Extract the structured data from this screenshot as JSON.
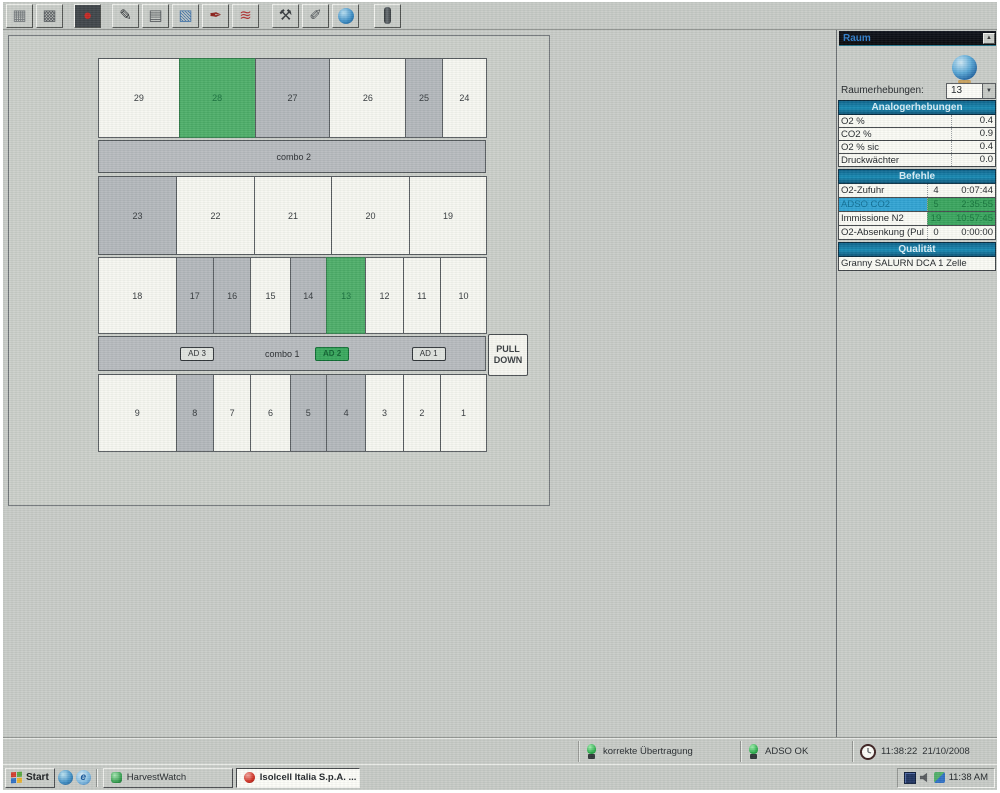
{
  "toolbar": {
    "icons": [
      {
        "name": "grid-icon",
        "glyph": "▦",
        "fg": "#6d7276",
        "ml": 0
      },
      {
        "name": "calendar-table-icon",
        "glyph": "▩",
        "fg": "#54585c",
        "ml": 0
      },
      {
        "name": "record-icon",
        "glyph": "●",
        "fg": "#c42420",
        "ml": 8,
        "cls": "dark"
      },
      {
        "name": "report-edit-icon",
        "glyph": "✎",
        "fg": "#26292c",
        "ml": 8
      },
      {
        "name": "table-icon",
        "glyph": "▤",
        "fg": "#4e5256",
        "ml": 0
      },
      {
        "name": "table-chart-icon",
        "glyph": "▧",
        "fg": "#3a6ea5",
        "ml": 0
      },
      {
        "name": "signature-icon",
        "glyph": "✒",
        "fg": "#8a1c16",
        "ml": 0
      },
      {
        "name": "line-chart-icon",
        "glyph": "≋",
        "fg": "#b03030",
        "ml": 0
      },
      {
        "name": "tools-icon",
        "glyph": "⚒",
        "fg": "#34383c",
        "ml": 10
      },
      {
        "name": "ink-pen-icon",
        "glyph": "✐",
        "fg": "#4a4e52",
        "ml": 0
      },
      {
        "name": "globe-toolbar-icon",
        "cls": "globe",
        "ml": 0
      },
      {
        "name": "thermometer-icon",
        "cls": "thermo",
        "ml": 12
      }
    ]
  },
  "room_map": {
    "pull_down_label": "PULL DOWN",
    "rows": [
      {
        "h": 80,
        "cells": [
          {
            "label": "29",
            "state": "white",
            "w": 83
          },
          {
            "label": "28",
            "state": "green",
            "w": 78
          },
          {
            "label": "27",
            "state": "gray",
            "w": 77
          },
          {
            "label": "26",
            "state": "white",
            "w": 78
          },
          {
            "label": "25",
            "state": "gray",
            "w": 37
          },
          {
            "label": "24",
            "state": "white",
            "w": 45
          }
        ]
      },
      {
        "name": "combo-2-bar",
        "h": 33,
        "label": "combo 2",
        "label_left": "46%"
      },
      {
        "h": 79,
        "cells": [
          {
            "label": "23",
            "state": "gray",
            "w": 78
          },
          {
            "label": "22",
            "state": "white",
            "w": 78
          },
          {
            "label": "21",
            "state": "white",
            "w": 77
          },
          {
            "label": "20",
            "state": "white",
            "w": 78
          },
          {
            "label": "19",
            "state": "white",
            "w": 77
          }
        ]
      },
      {
        "h": 77,
        "cells": [
          {
            "label": "18",
            "state": "white",
            "w": 80
          },
          {
            "label": "17",
            "state": "gray",
            "w": 38
          },
          {
            "label": "16",
            "state": "gray",
            "w": 38
          },
          {
            "label": "15",
            "state": "white",
            "w": 40
          },
          {
            "label": "14",
            "state": "gray",
            "w": 37
          },
          {
            "label": "13",
            "state": "green",
            "w": 40
          },
          {
            "label": "12",
            "state": "white",
            "w": 38
          },
          {
            "label": "11",
            "state": "white",
            "w": 38
          },
          {
            "label": "10",
            "state": "white",
            "w": 47
          }
        ]
      },
      {
        "name": "combo-1-bar",
        "h": 35,
        "label": "combo 1",
        "label_left": "43%",
        "buttons": [
          {
            "label": "AD 3",
            "left": "21%",
            "green": false
          },
          {
            "label": "AD 2",
            "left": "56%",
            "green": true
          },
          {
            "label": "AD 1",
            "left": "81%",
            "green": false
          }
        ]
      },
      {
        "h": 78,
        "cells": [
          {
            "label": "9",
            "state": "white",
            "w": 80
          },
          {
            "label": "8",
            "state": "gray",
            "w": 38
          },
          {
            "label": "7",
            "state": "white",
            "w": 38
          },
          {
            "label": "6",
            "state": "white",
            "w": 40
          },
          {
            "label": "5",
            "state": "gray",
            "w": 37
          },
          {
            "label": "4",
            "state": "gray",
            "w": 40
          },
          {
            "label": "3",
            "state": "white",
            "w": 38
          },
          {
            "label": "2",
            "state": "white",
            "w": 38
          },
          {
            "label": "1",
            "state": "white",
            "w": 47
          }
        ]
      }
    ]
  },
  "side_panel": {
    "title": "Raum",
    "selector_label": "Raumerhebungen:",
    "selector_value": "13",
    "analog": {
      "header": "Analogerhebungen",
      "rows": [
        {
          "label": "O2 %",
          "value": "0.4"
        },
        {
          "label": "CO2 %",
          "value": "0.9"
        },
        {
          "label": "O2 % sic",
          "value": "0.4"
        },
        {
          "label": "Druckwächter",
          "value": "0.0"
        }
      ]
    },
    "befehle": {
      "header": "Befehle",
      "rows": [
        {
          "label": "O2-Zufuhr",
          "count": "4",
          "time": "0:07:44",
          "style": "plain"
        },
        {
          "label": "ADSO CO2",
          "count": "5",
          "time": "2:35:55",
          "style": "active"
        },
        {
          "label": "Immissione N2",
          "count": "19",
          "time": "10:57:45",
          "style": "running"
        },
        {
          "label": "O2-Absenkung (Pul",
          "count": "0",
          "time": "0:00:00",
          "style": "plain"
        }
      ]
    },
    "qualitaet": {
      "header": "Qualität",
      "value": "Granny SALURN DCA 1  Zelle"
    }
  },
  "status_bar": {
    "connection": "korrekte Übertragung",
    "adso": "ADSO OK",
    "time": "11:38:22",
    "date": "21/10/2008"
  },
  "taskbar": {
    "start": "Start",
    "tasks": [
      {
        "label": "HarvestWatch"
      },
      {
        "label": "Isolcell Italia S.p.A.  ..."
      }
    ],
    "quick_launch_2_glyph": "e",
    "tray_time": "11:38 AM"
  },
  "colors": {
    "cell_green": "#4bad67",
    "cell_gray": "#b3b7bb",
    "header_teal": "#0e6f96",
    "row_cyan": "#2ea2d3",
    "value_green": "#37a45c"
  }
}
